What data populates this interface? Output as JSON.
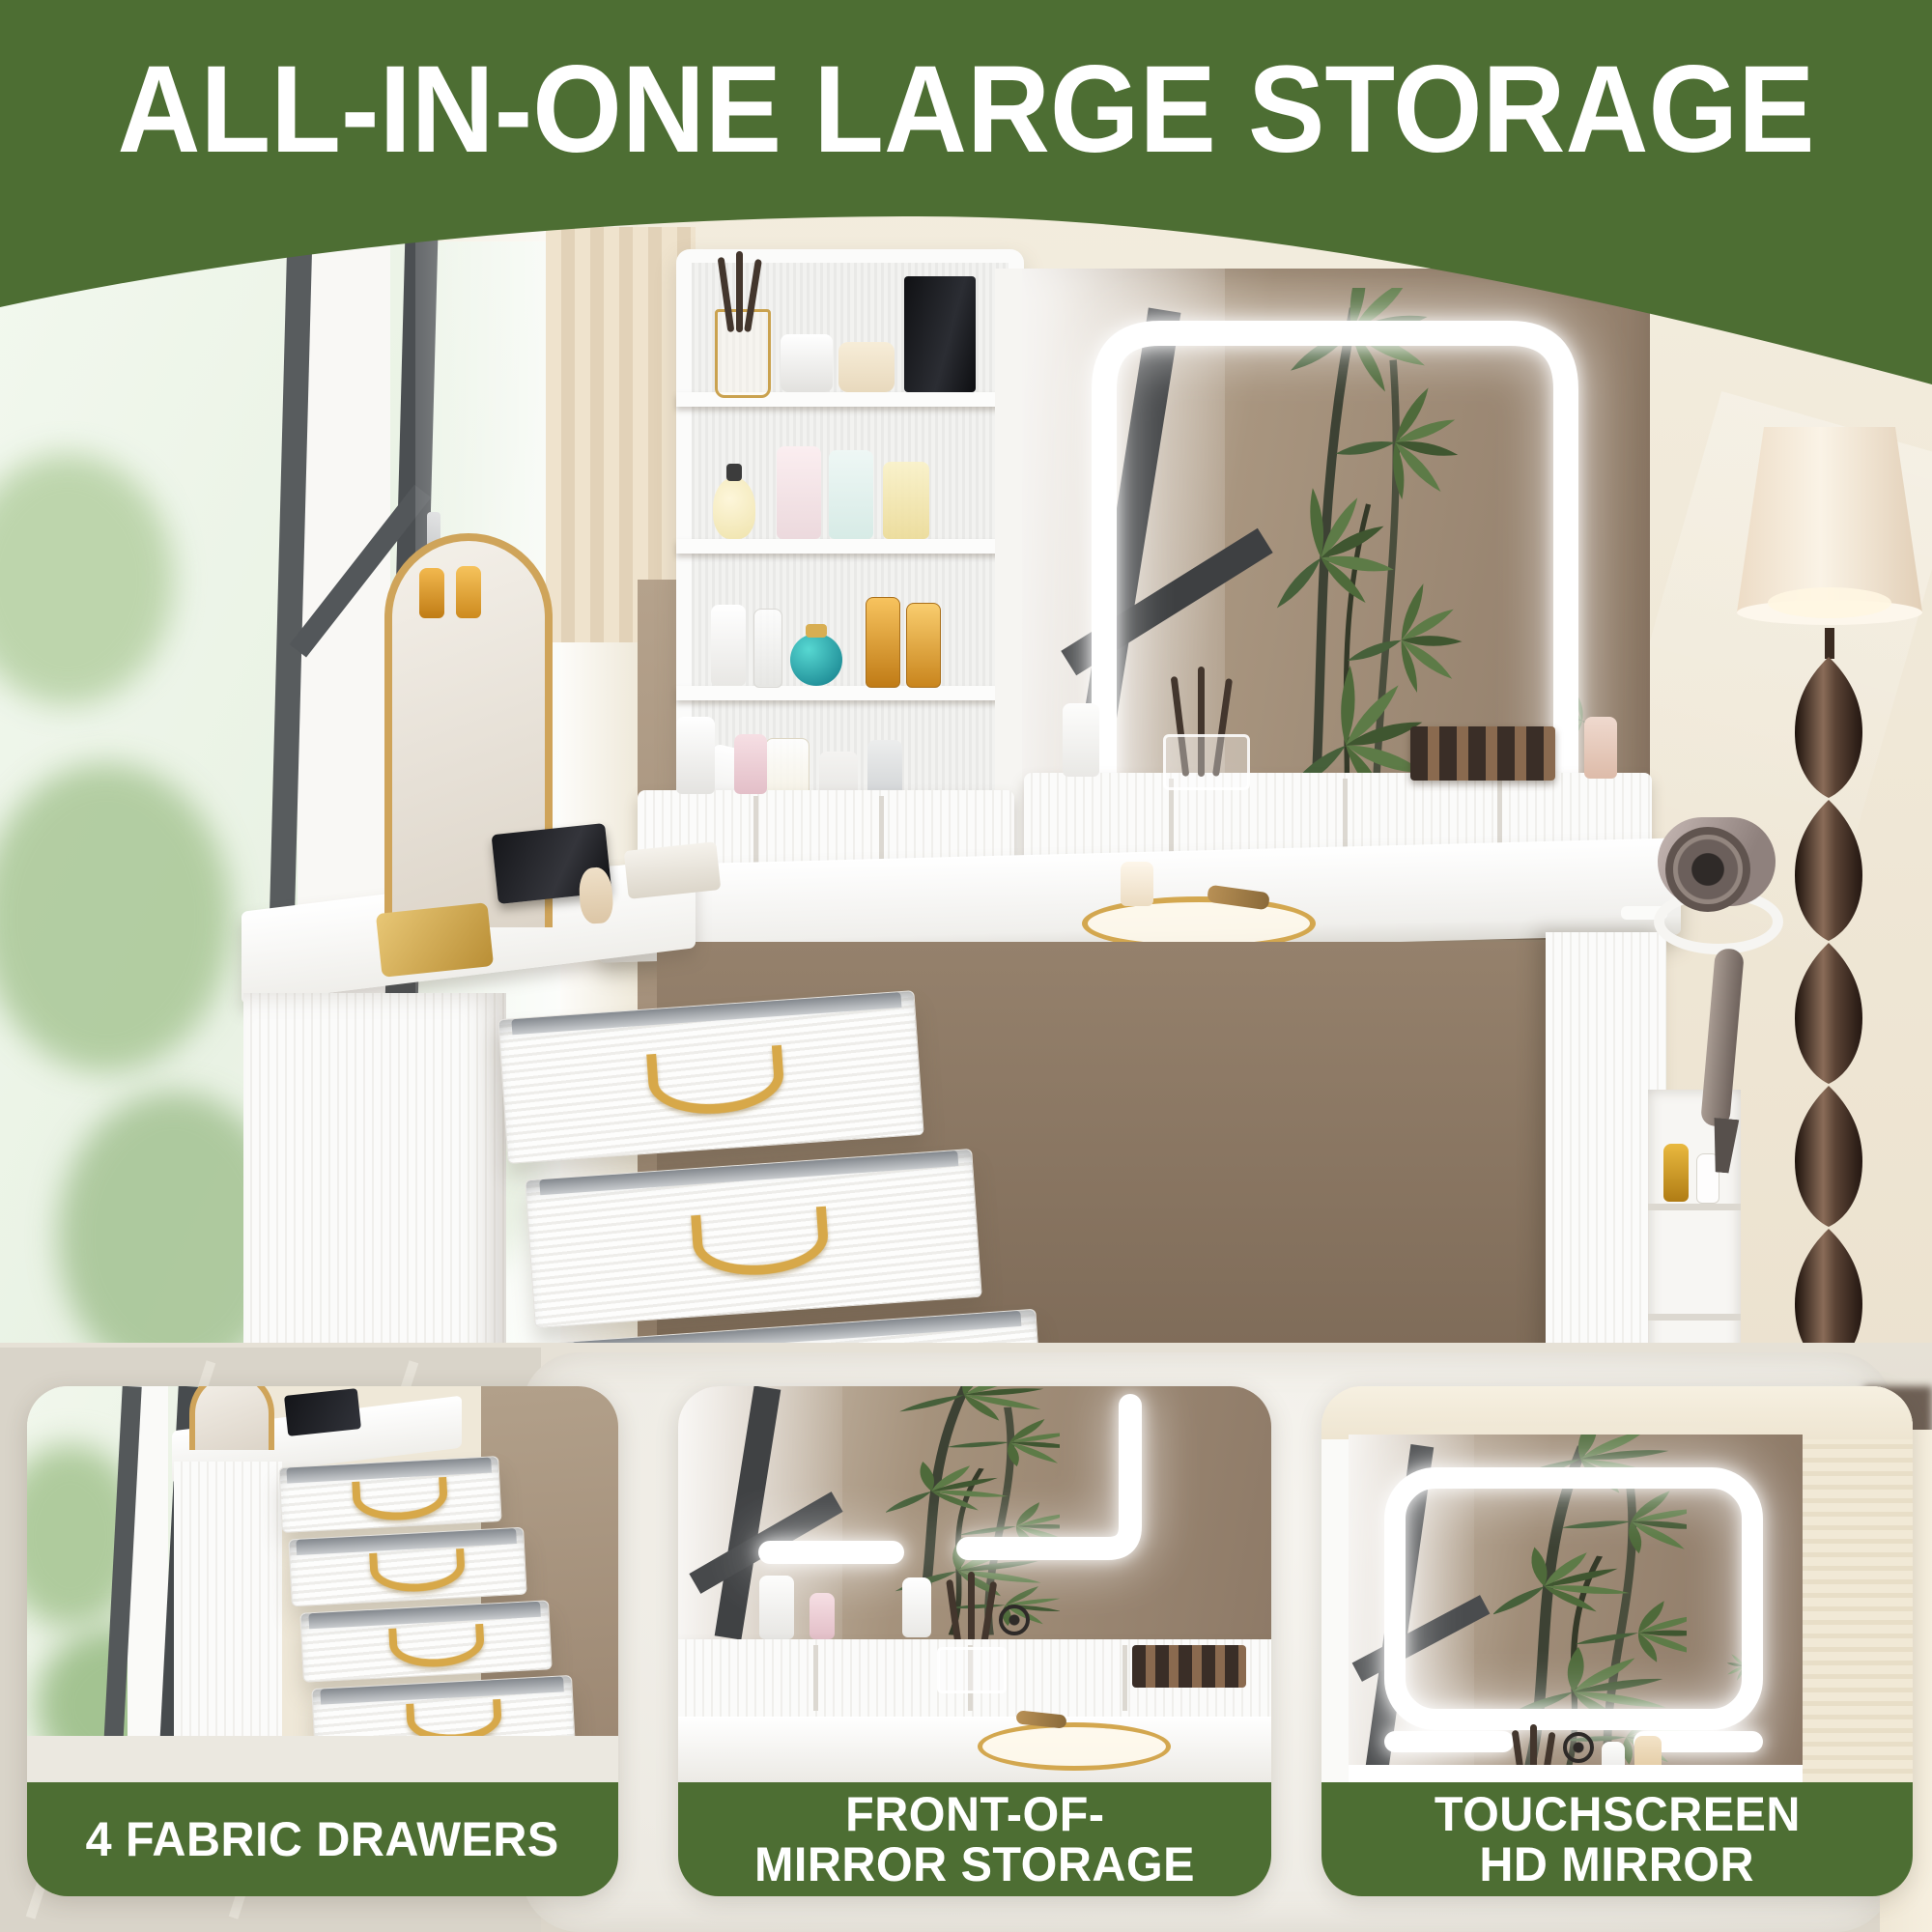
{
  "header": {
    "title": "ALL-IN-ONE LARGE STORAGE",
    "background_color": "#4d6e33",
    "text_color": "#ffffff"
  },
  "insets": [
    {
      "id": "fabric-drawers",
      "caption_lines": [
        "4 FABRIC DRAWERS"
      ]
    },
    {
      "id": "front-of-mirror-storage",
      "caption_lines": [
        "FRONT-OF-",
        "MIRROR STORAGE"
      ]
    },
    {
      "id": "touchscreen-hd-mirror",
      "caption_lines": [
        "TOUCHSCREEN",
        "HD MIRROR"
      ]
    }
  ],
  "colors": {
    "accent_green": "#4d6e33",
    "caption_text": "#ffffff",
    "wall_cream": "#f1e9d7",
    "accent_wall_taupe": "#a8947e",
    "furniture_white": "#fbfbfa",
    "handle_gold": "#d7a849",
    "lamp_bronze": "#3a281e"
  },
  "icons": {
    "touch_sensor": "concentric-circles",
    "led_strip": "rounded-rect-glow"
  }
}
